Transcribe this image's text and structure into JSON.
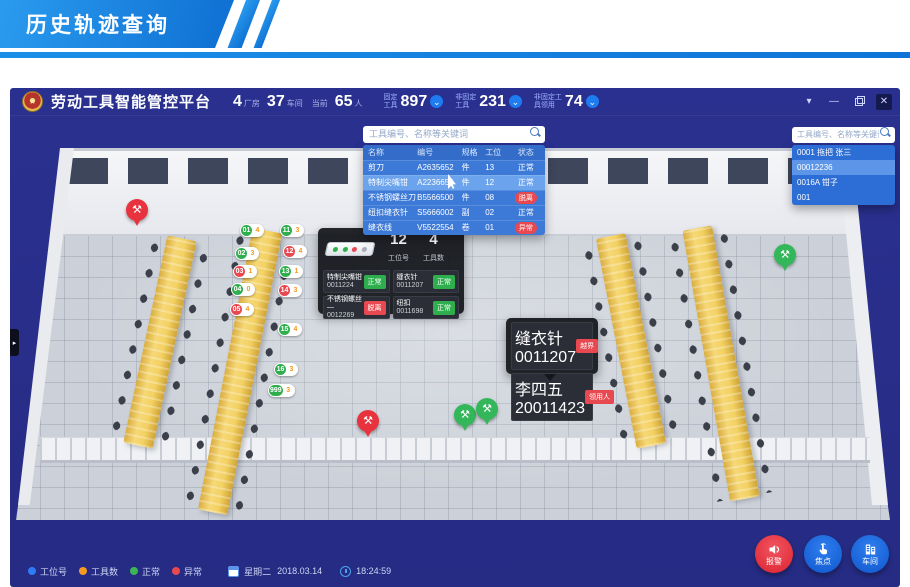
{
  "banner": {
    "title": "历史轨迹查询"
  },
  "header": {
    "app_title": "劳动工具智能管控平台",
    "factory_count": "4",
    "factory_unit": "厂房",
    "workshop_count": "37",
    "workshop_unit": "车间",
    "current_label": "当前",
    "current_count": "65",
    "current_unit": "人",
    "stats": [
      {
        "label_line1": "固定",
        "label_line2": "工具",
        "value": "897"
      },
      {
        "label_line1": "非固定",
        "label_line2": "工具",
        "value": "231"
      },
      {
        "label_line1": "非固定工",
        "label_line2": "具领用",
        "value": "74"
      }
    ]
  },
  "search_panel": {
    "placeholder": "工具编号、名称等关键词",
    "columns": [
      "名称",
      "编号",
      "规格",
      "工位",
      "状态"
    ],
    "rows": [
      {
        "name": "剪刀",
        "code": "A2635652",
        "spec": "件",
        "station": "13",
        "status": "正常"
      },
      {
        "name": "特制尖嘴钳",
        "code": "A2236654",
        "spec": "件",
        "station": "12",
        "status": "正常"
      },
      {
        "name": "不锈钢螺丝刀",
        "code": "B5566500",
        "spec": "件",
        "station": "08",
        "status": "脱离"
      },
      {
        "name": "纽扣缝衣针",
        "code": "S5666002",
        "spec": "副",
        "station": "02",
        "status": "正常"
      },
      {
        "name": "缝衣线",
        "code": "V5522554",
        "spec": "卷",
        "station": "01",
        "status": "异常"
      }
    ]
  },
  "right_panel": {
    "placeholder": "工具编号、名称等关键词",
    "items": [
      "0001 拖把 张三",
      "00012236",
      "0016A 钳子",
      "001"
    ]
  },
  "station_tooltip": {
    "station_value": "12",
    "station_label": "工位号",
    "tools_value": "4",
    "tools_label": "工具数",
    "cells": [
      {
        "name": "特制尖嘴钳",
        "code": "0011224",
        "status": "正常"
      },
      {
        "name": "缝衣针",
        "code": "0011207",
        "status": "正常"
      },
      {
        "name": "不锈钢螺丝—",
        "code": "0012269",
        "status": "脱离"
      },
      {
        "name": "纽扣",
        "code": "0011698",
        "status": "正常"
      }
    ]
  },
  "alert_tooltip": {
    "rows": [
      {
        "name": "缝衣针",
        "code": "0011207",
        "badge": "越界"
      },
      {
        "name": "李四五",
        "code": "20011423",
        "badge": "领用人"
      }
    ]
  },
  "badges": [
    {
      "station": "01",
      "count": "4",
      "status": "normal"
    },
    {
      "station": "02",
      "count": "3",
      "status": "normal"
    },
    {
      "station": "03",
      "count": "1",
      "status": "alert"
    },
    {
      "station": "04",
      "count": "0",
      "status": "normal"
    },
    {
      "station": "05",
      "count": "4",
      "status": "alert"
    },
    {
      "station": "11",
      "count": "3",
      "status": "normal"
    },
    {
      "station": "12",
      "count": "4",
      "status": "alert"
    },
    {
      "station": "13",
      "count": "1",
      "status": "normal"
    },
    {
      "station": "14",
      "count": "3",
      "status": "alert"
    },
    {
      "station": "15",
      "count": "4",
      "status": "normal"
    },
    {
      "station": "16",
      "count": "3",
      "status": "normal"
    },
    {
      "station": "999",
      "count": "3",
      "status": "normal"
    }
  ],
  "legend": {
    "items": [
      {
        "label": "工位号",
        "color": "#2f7bf6"
      },
      {
        "label": "工具数",
        "color": "#f59a23"
      },
      {
        "label": "正常",
        "color": "#3cb554"
      },
      {
        "label": "异常",
        "color": "#e8494f"
      }
    ],
    "weekday": "星期二",
    "date": "2018.03.14",
    "time": "18:24:59"
  },
  "buttons": [
    {
      "label": "报警",
      "icon": "alarm-speaker-icon",
      "color": "#e8333f"
    },
    {
      "label": "焦点",
      "icon": "pointer-hand-icon",
      "color": "#1668e3"
    },
    {
      "label": "车间",
      "icon": "workshop-building-icon",
      "color": "#1668e3"
    }
  ],
  "glyphs": {
    "tools": "⚒",
    "chevron_down": "⌄",
    "win_chevron": "▾",
    "minimize": "—",
    "close": "✕",
    "drawer_arrow": "▸",
    "logo_star": "★"
  },
  "colors": {
    "banner_blue": "#1286e8",
    "window_bg": "#272e8a",
    "panel_blue": "#3d7ad8",
    "normal_green": "#2fae4e",
    "alert_red": "#e8484f",
    "count_orange": "#f59a23",
    "button_blue": "#1668e3",
    "button_red": "#e8333f"
  }
}
